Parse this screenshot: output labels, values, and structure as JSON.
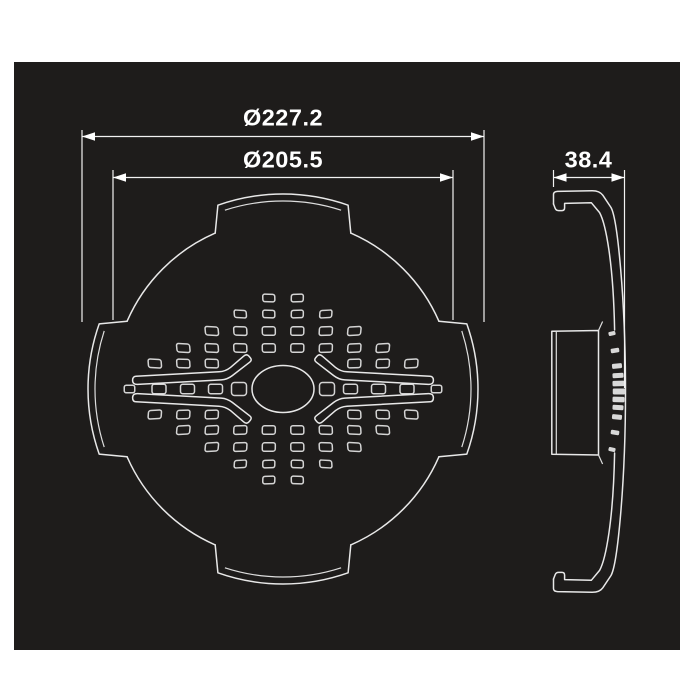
{
  "dimensions": {
    "front_outer_diameter": "Ø227.2",
    "front_inner_diameter": "Ø205.5",
    "side_depth": "38.4"
  },
  "colors": {
    "page_bg": "#ffffff",
    "panel_bg": "#1e1c1b",
    "line": "#e8e8e8",
    "slot_line": "#d4d4d4",
    "dim_line": "#f2f2f2",
    "arrow_fill": "#ffffff",
    "text": "#ffffff",
    "mark_fill": "#d8d8d8"
  },
  "drawing": {
    "panel": {
      "x": 14,
      "y": 62,
      "w": 666,
      "h": 588
    },
    "front": {
      "cx": 283,
      "cy": 389,
      "r": 170,
      "tab_outer_r": 195,
      "tab_inner_r": 188,
      "tab_half_angle": 19.5,
      "step_half_angle": 23.5,
      "inner_half_angle": 18,
      "hole_rx": 31,
      "hole_ry": 23.5,
      "col_offset": 14.25,
      "col_spacing": 28.5,
      "slot": {
        "w": 13,
        "h": 8.5,
        "rx": 2.2
      },
      "outer_row_slot": {
        "w": 12,
        "h": 7.5,
        "rx": 2
      },
      "rows": [
        [
          -91,
          0,
          1
        ],
        [
          -75,
          0,
          2
        ],
        [
          -58,
          0,
          3
        ],
        [
          -41,
          0,
          4
        ],
        [
          -25.5,
          2,
          3
        ],
        [
          25.5,
          2,
          3
        ],
        [
          41,
          0,
          4
        ],
        [
          58,
          0,
          3
        ],
        [
          75,
          0,
          2
        ],
        [
          91,
          0,
          1
        ]
      ],
      "center_row": [
        {
          "dx": 44,
          "w": 15,
          "h": 13,
          "rx": 3
        },
        {
          "dx": 67.5,
          "w": 14,
          "h": 9.5,
          "rx": 2.2
        },
        {
          "dx": 95.5,
          "w": 14,
          "h": 9.5,
          "rx": 2.2
        },
        {
          "dx": 124,
          "w": 14,
          "h": 9.5,
          "rx": 2.2
        },
        {
          "dx": 153.5,
          "w": 10.5,
          "h": 7.5,
          "rx": 2
        }
      ],
      "skew_gain": 30,
      "skew_clamp": 14,
      "rot_ratio": 0.4
    },
    "side": {
      "marks": [
        [
          -58,
          612,
          7,
          4
        ],
        [
          -41,
          615,
          8.5,
          4.5
        ],
        [
          -25.5,
          617,
          10,
          5
        ],
        [
          -16,
          618,
          11,
          5
        ],
        [
          -8,
          618.5,
          12,
          5.5
        ],
        [
          0,
          619,
          12.5,
          6
        ],
        [
          8,
          618.5,
          12,
          5.5
        ],
        [
          16,
          618,
          11,
          5
        ],
        [
          25.5,
          617,
          10,
          5
        ],
        [
          41,
          615,
          8.5,
          4.5
        ],
        [
          58,
          612,
          7,
          4
        ]
      ],
      "mark_cy": 391.5,
      "mark_rot_per_dy": 0.22
    },
    "dims": [
      {
        "x1": 82,
        "x2": 484,
        "y": 136.5,
        "ext": [
          {
            "x": 82,
            "y1": 130,
            "y2": 322
          },
          {
            "x": 484,
            "y1": 130,
            "y2": 322
          }
        ]
      },
      {
        "x1": 113,
        "x2": 453,
        "y": 177.5,
        "ext": [
          {
            "x": 113,
            "y1": 170,
            "y2": 320
          },
          {
            "x": 453,
            "y1": 170,
            "y2": 320
          }
        ]
      },
      {
        "x1": 553.5,
        "x2": 624.5,
        "y": 177.5,
        "ext": [
          {
            "x": 553.5,
            "y1": 170,
            "y2": 187
          },
          {
            "x": 624.5,
            "y1": 170,
            "y2": 388
          }
        ]
      }
    ],
    "arrow": {
      "len": 13,
      "half_h": 4.3
    }
  }
}
